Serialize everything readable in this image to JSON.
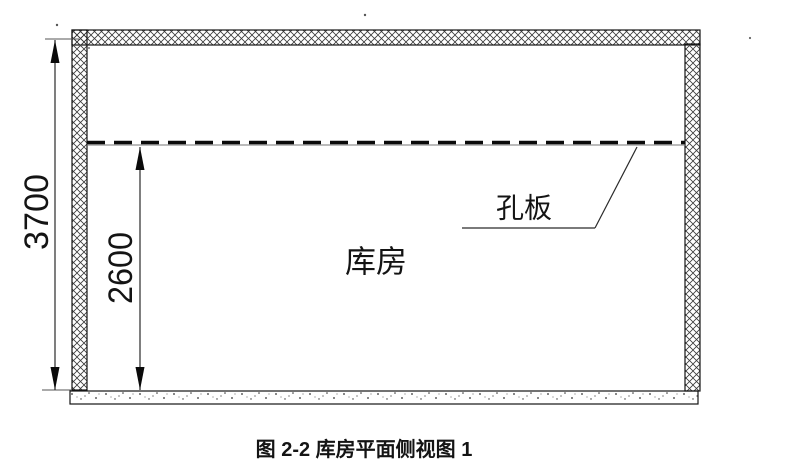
{
  "figure": {
    "caption": "图 2-2 库房平面侧视图 1",
    "room_label": "库房",
    "plate_label": "孔板",
    "dimensions": {
      "total_height": "3700",
      "plate_height": "2600"
    },
    "colors": {
      "line": "#141414",
      "thin_line": "#777777",
      "background": "#ffffff"
    }
  }
}
